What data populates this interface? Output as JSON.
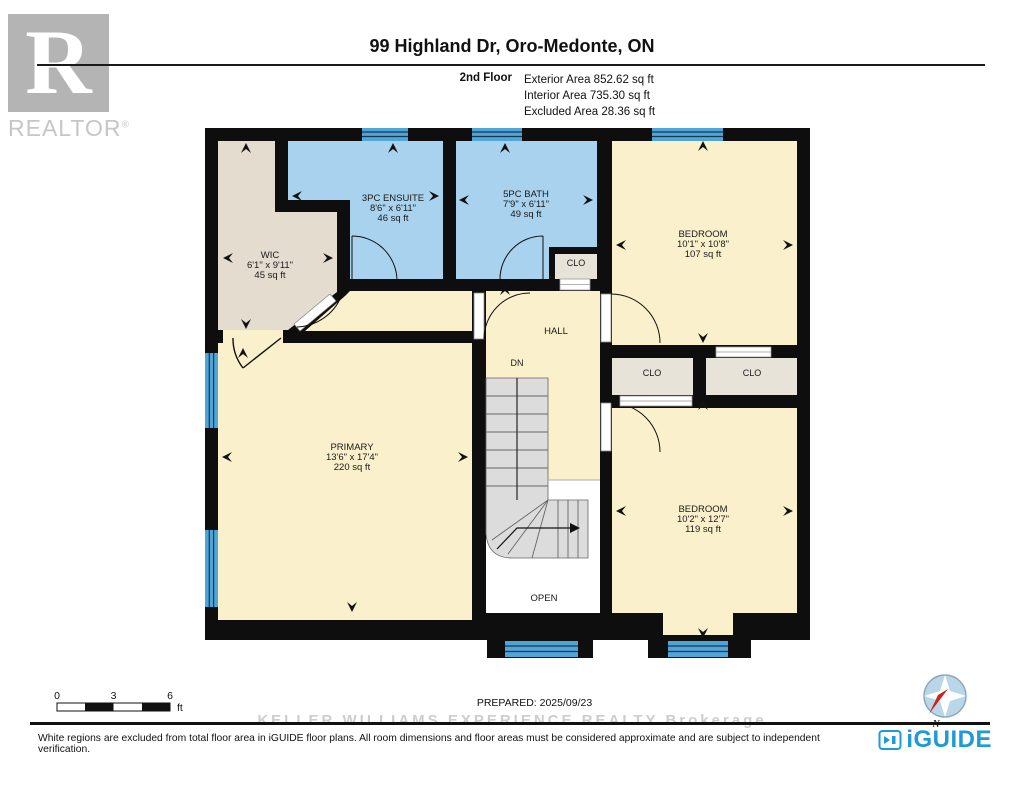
{
  "header": {
    "title": "99 Highland Dr, Oro-Medonte, ON",
    "floor_label": "2nd Floor",
    "area_lines": [
      "Exterior Area 852.62 sq ft",
      "Interior Area 735.30 sq ft",
      "Excluded Area 28.36 sq ft"
    ]
  },
  "realtor": {
    "letter": "R",
    "text": "REALTOR",
    "reg": "®"
  },
  "rooms": {
    "wic": {
      "name": "WIC",
      "dims": "6'1\" x 9'11\"",
      "area": "45 sq ft"
    },
    "ensuite": {
      "name": "3PC ENSUITE",
      "dims": "8'6\" x 6'11\"",
      "area": "46 sq ft"
    },
    "bath": {
      "name": "5PC BATH",
      "dims": "7'9\" x 6'11\"",
      "area": "49 sq ft"
    },
    "bedroom_top": {
      "name": "BEDROOM",
      "dims": "10'1\" x 10'8\"",
      "area": "107 sq ft"
    },
    "primary": {
      "name": "PRIMARY",
      "dims": "13'6\" x 17'4\"",
      "area": "220 sq ft"
    },
    "bedroom_bottom": {
      "name": "BEDROOM",
      "dims": "10'2\" x 12'7\"",
      "area": "119 sq ft"
    }
  },
  "labels": {
    "hall": "HALL",
    "dn": "DN",
    "open": "OPEN",
    "clo_bath": "CLO",
    "clo_left": "CLO",
    "clo_right": "CLO"
  },
  "scale_bar": {
    "tick_0": "0",
    "tick_3": "3",
    "tick_6": "6",
    "unit": "ft"
  },
  "footer": {
    "prepared": "PREPARED: 2025/09/23",
    "watermark": "KELLER WILLIAMS EXPERIENCE REALTY Brokerage",
    "disclaimer": "White regions are excluded from total floor area in iGUIDE floor plans. All room dimensions and floor areas must be considered approximate and are subject to independent verification.",
    "brand": "iGUIDE",
    "compass_n": "N"
  },
  "colors": {
    "wall": "#0E0E0E",
    "room_cream": "#FAF0CC",
    "bath_blue": "#A8D2EE",
    "closet_beige": "#E3DCCF",
    "closet_gray": "#E8E3D9",
    "window_blue": "#4FA5D8",
    "stairs_gray": "#DCDCDC",
    "brand_blue": "#1F9AD7",
    "compass_red": "#C8251D"
  }
}
